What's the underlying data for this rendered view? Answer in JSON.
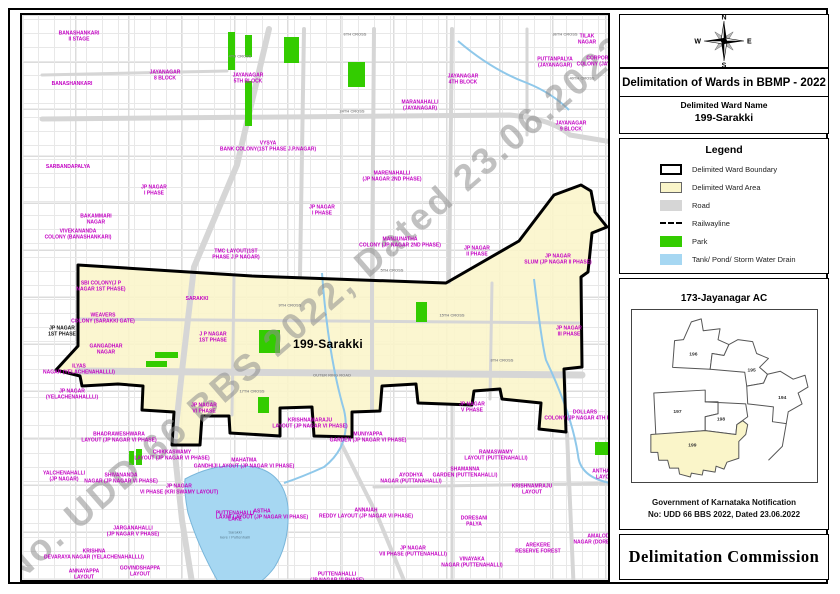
{
  "colors": {
    "ward_area": "#FAF5C9",
    "park": "#33CC00",
    "water": "#A6D7F2",
    "road": "#D6D6D6",
    "label_magenta": "#C300C3",
    "watermark": "#8F8F8F"
  },
  "map": {
    "watermark": "No. UDD 66 BBS 2022, Dated 23.06.2022",
    "area_labels": [
      {
        "t": "BANASHANKARI\nII STAGE",
        "x": 57,
        "y": 22
      },
      {
        "t": "BANASHANKARI",
        "x": 50,
        "y": 70
      },
      {
        "t": "SARBANDAPALYA",
        "x": 46,
        "y": 153
      },
      {
        "t": "JAYANAGAR\n8 BLOCK",
        "x": 143,
        "y": 61
      },
      {
        "t": "JAYANAGAR\n5TH BLOCK",
        "x": 226,
        "y": 64
      },
      {
        "t": "MARANAHALLI\n(JAYANAGAR)",
        "x": 398,
        "y": 91
      },
      {
        "t": "TILAK\nNAGAR",
        "x": 565,
        "y": 25
      },
      {
        "t": "PUTTANPALYA\n(JAYANAGAR)",
        "x": 533,
        "y": 48
      },
      {
        "t": "CORPORATION\nCOLONY (JAYANAGAR)",
        "x": 583,
        "y": 47
      },
      {
        "t": "JAYANAGAR\n4TH BLOCK",
        "x": 441,
        "y": 65
      },
      {
        "t": "JAYANAGAR\n9 BLOCK",
        "x": 549,
        "y": 112
      },
      {
        "t": "VYSYA\nBANK COLONY(1ST PHASE J.P.NAGAR)",
        "x": 246,
        "y": 132
      },
      {
        "t": "MARENAHALLI\n(JP NAGAR 2ND PHASE)",
        "x": 370,
        "y": 162
      },
      {
        "t": "JP NAGAR\nI PHASE",
        "x": 132,
        "y": 176
      },
      {
        "t": "JP NAGAR\nI PHASE",
        "x": 300,
        "y": 196
      },
      {
        "t": "TMC LAYOUT(1ST\nPHASE J.P NAGAR)",
        "x": 214,
        "y": 240
      },
      {
        "t": "BAKAMMARI\nNAGAR",
        "x": 74,
        "y": 205
      },
      {
        "t": "VIVEKANANDA\nCOLONY (BANASHANKARI)",
        "x": 56,
        "y": 220
      },
      {
        "t": "MANJUNATHA\nCOLONY (JP NAGAR 2ND PHASE)",
        "x": 378,
        "y": 228
      },
      {
        "t": "JP NAGAR\nII PHASE",
        "x": 455,
        "y": 237
      },
      {
        "t": "JP NAGAR\nSLUM (JP NAGAR II PHASE)",
        "x": 536,
        "y": 245
      },
      {
        "t": "JP NAGAR\nIII PHASE",
        "x": 547,
        "y": 317
      },
      {
        "t": "SBI COLONY(J P\nNAGAR 1ST PHASE)",
        "x": 79,
        "y": 272
      },
      {
        "t": "SARAKKI",
        "x": 175,
        "y": 285
      },
      {
        "t": "WEAVERS\nCOLONY (SARAKKI GATE)",
        "x": 81,
        "y": 304
      },
      {
        "t": "J P NAGAR\n1ST PHASE",
        "x": 191,
        "y": 323
      },
      {
        "t": "JP NAGAR\n1ST PHASE",
        "x": 40,
        "y": 317,
        "v": "black"
      },
      {
        "t": "GANGADHAR\nNAGAR",
        "x": 84,
        "y": 335
      },
      {
        "t": "ILYAS\nNAGAR (YELACHENAHALLLI)",
        "x": 57,
        "y": 355
      },
      {
        "t": "JP NAGAR\n(YELACHENAHALLLI)",
        "x": 50,
        "y": 380
      },
      {
        "t": "JP NAGAR\nVI PHASE",
        "x": 182,
        "y": 394
      },
      {
        "t": "BHADRAWESHWARA\nLAYOUT (JP NAGAR VI PHASE)",
        "x": 97,
        "y": 423
      },
      {
        "t": "CHIKKASWAMY\nLAYOUT (JP NAGAR VI PHASE)",
        "x": 150,
        "y": 441
      },
      {
        "t": "SHIVANANDA\nNAGAR (JP NAGAR VI PHASE)",
        "x": 99,
        "y": 464
      },
      {
        "t": "JP NAGAR\nVI PHASE (KRI SWAMY LAYOUT)",
        "x": 157,
        "y": 475
      },
      {
        "t": "YALCHENAHALLI\n(JP NAGAR)",
        "x": 42,
        "y": 462
      },
      {
        "t": "KRISHNAMARAJU\nLAYOUT (JP NAGAR VI PHASE)",
        "x": 288,
        "y": 409
      },
      {
        "t": "MUNIYAPPA\nGARDEN (JP NAGAR VI PHASE)",
        "x": 346,
        "y": 423
      },
      {
        "t": "MAHATMA\nGANDHIJI LAYOUT (JP NAGAR VI PHASE)",
        "x": 222,
        "y": 449
      },
      {
        "t": "AYODHYA\nNAGAR (PUTTANAHALLI)",
        "x": 389,
        "y": 464
      },
      {
        "t": "ASTHA\nLAXMI LAYOUT (JP NAGAR VI PHASE)",
        "x": 240,
        "y": 500
      },
      {
        "t": "ANNAIAH\nREDDY LAYOUT (JP NAGAR VI PHASE)",
        "x": 344,
        "y": 499
      },
      {
        "t": "JP NAGAR\nVII PHASE (PUTTENAHALLI)",
        "x": 391,
        "y": 537
      },
      {
        "t": "PUTTENAHALLI\n(JP NAGAR VI PHASE)",
        "x": 315,
        "y": 563
      },
      {
        "t": "RAGHAVENDRA\nNAGAR (KONANKUNTE)",
        "x": 201,
        "y": 573
      },
      {
        "t": "KRISHNA\nDEVARAYA NAGAR (YELACHENAHALLLI)",
        "x": 72,
        "y": 540
      },
      {
        "t": "ANNAYAPPA\nLAYOUT",
        "x": 62,
        "y": 560
      },
      {
        "t": "GOVINDSHAPPA\nLAYOUT",
        "x": 118,
        "y": 557
      },
      {
        "t": "JARGANAHALLI\n(JP NAGAR V PHASE)",
        "x": 111,
        "y": 517
      },
      {
        "t": "DOLLARS\nCOLONY (JP NAGAR 4TH PHASE)",
        "x": 563,
        "y": 401
      },
      {
        "t": "JP NAGAR\nV PHASE",
        "x": 450,
        "y": 393
      },
      {
        "t": "RAMASWAMY\nLAYOUT (PUTTENAHALLI)",
        "x": 474,
        "y": 441
      },
      {
        "t": "SHAMANNA\nGARDEN (PUTTENAHALLI)",
        "x": 443,
        "y": 458
      },
      {
        "t": "KRISHNAMRAJU\nLAYOUT",
        "x": 510,
        "y": 475
      },
      {
        "t": "ANTHAPPA\nLAYOUT",
        "x": 584,
        "y": 460
      },
      {
        "t": "DORESANI\nPALYA",
        "x": 452,
        "y": 507
      },
      {
        "t": "AREKERE\nRESERVE FOREST",
        "x": 516,
        "y": 534
      },
      {
        "t": "AMALODBHAVI\nNAGAR (DORESANIPALYA)",
        "x": 584,
        "y": 525
      },
      {
        "t": "VINAYAKA\nNAGAR (PUTTENAHALLI)",
        "x": 450,
        "y": 548
      },
      {
        "t": "PARADISE\nCOLONY (JP NAGAR VI PHASE)",
        "x": 433,
        "y": 572
      },
      {
        "t": "VENKATADRI\nLAYOUT (PUTTENAHALLI)",
        "x": 575,
        "y": 572
      },
      {
        "t": "PUTTENAHALLI\nLAKE",
        "x": 213,
        "y": 502
      },
      {
        "t": "Sarakki\nkere / Puttenhalli",
        "x": 213,
        "y": 520,
        "v": "tiny"
      },
      {
        "t": "199-Sarakki",
        "x": 306,
        "y": 330,
        "v": "big"
      }
    ],
    "street_labels": [
      {
        "t": "4TH CROSS",
        "x": 218,
        "y": 41
      },
      {
        "t": "6TH CROSS",
        "x": 333,
        "y": 19
      },
      {
        "t": "36TH CROSS",
        "x": 543,
        "y": 19
      },
      {
        "t": "40TH CROSS",
        "x": 560,
        "y": 63
      },
      {
        "t": "24TH CROSS",
        "x": 330,
        "y": 96
      },
      {
        "t": "5TH CROSS",
        "x": 370,
        "y": 255
      },
      {
        "t": "9TH CROSS",
        "x": 268,
        "y": 290
      },
      {
        "t": "15TH CROSS",
        "x": 430,
        "y": 300
      },
      {
        "t": "8TH CROSS",
        "x": 480,
        "y": 345
      },
      {
        "t": "OUTER RING ROAD",
        "x": 310,
        "y": 360
      },
      {
        "t": "17TH CROSS",
        "x": 230,
        "y": 376
      }
    ]
  },
  "panel": {
    "compass": {
      "n": "N",
      "s": "S",
      "e": "E",
      "w": "W"
    },
    "title": "Delimitation of Wards in BBMP - 2022",
    "ward_name_heading": "Delimited Ward Name",
    "ward_name": "199-Sarakki",
    "legend": {
      "title": "Legend",
      "items": [
        {
          "label": "Delimited Ward Boundary",
          "swatch": "boundary"
        },
        {
          "label": "Delimited Ward Area",
          "swatch": "area"
        },
        {
          "label": "Road",
          "swatch": "road"
        },
        {
          "label": "Railwayline",
          "swatch": "rail"
        },
        {
          "label": "Park",
          "swatch": "park"
        },
        {
          "label": "Tank/ Pond/ Storm Water Drain",
          "swatch": "water"
        }
      ]
    },
    "inset": {
      "title": "173-Jayanagar AC",
      "wards": [
        "196",
        "195",
        "194",
        "197",
        "198",
        "199"
      ],
      "highlight": "199"
    },
    "notification_line1": "Government of Karnataka Notification",
    "notification_line2": "No: UDD 66 BBS 2022, Dated 23.06.2022",
    "commission": "Delimitation Commission"
  }
}
